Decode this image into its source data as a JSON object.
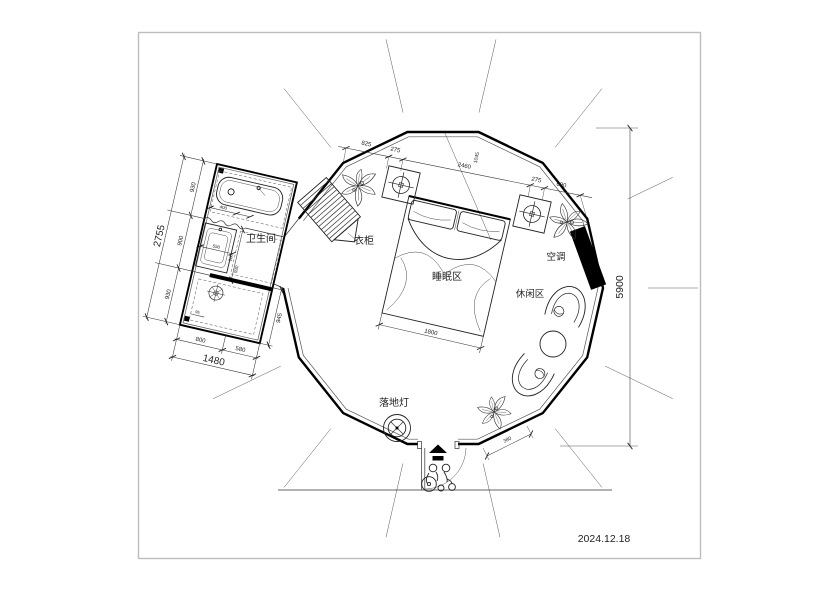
{
  "meta": {
    "date": "2024.12.18"
  },
  "labels": {
    "bathroom": "卫生间",
    "wardrobe": "衣柜",
    "sleeping": "睡眠区",
    "leisure": "休闲区",
    "ac": "空调",
    "floor_lamp": "落地灯"
  },
  "dims": {
    "top": [
      "825",
      "275",
      "2460",
      "1045",
      "275",
      "690"
    ],
    "height_total": "5900",
    "bed_width": "1800",
    "door_side": "380",
    "bath_left": [
      "930",
      "900",
      "930"
    ],
    "bath_left_total": "2755",
    "bath_bottom": [
      "800",
      "580"
    ],
    "bath_bottom_total": "1480",
    "bath_right": "945",
    "inner": {
      "tub": "400",
      "sink": "550",
      "mid_a": "900",
      "mid_b": "930",
      "toilet": "95"
    }
  }
}
